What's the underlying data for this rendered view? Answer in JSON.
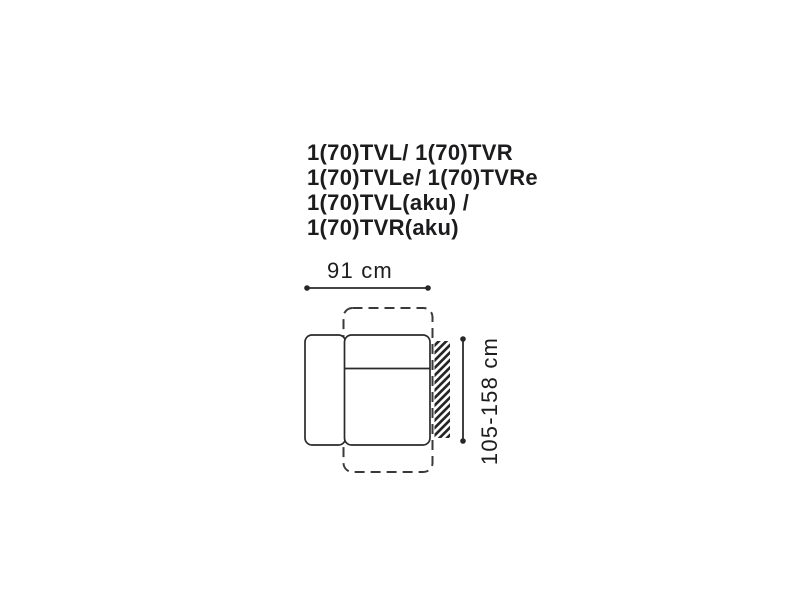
{
  "background": "#ffffff",
  "colors": {
    "line": "#2a2a2a",
    "dashed_line": "#3a3a3a",
    "text": "#1d1d1f"
  },
  "title": {
    "lines": [
      "1(70)TVL/ 1(70)TVR",
      "1(70)TVLe/ 1(70)TVRe",
      "1(70)TVL(aku) /",
      "1(70)TVR(aku)"
    ]
  },
  "diagram": {
    "width_label": "91 cm",
    "depth_label": "105-158 cm"
  }
}
